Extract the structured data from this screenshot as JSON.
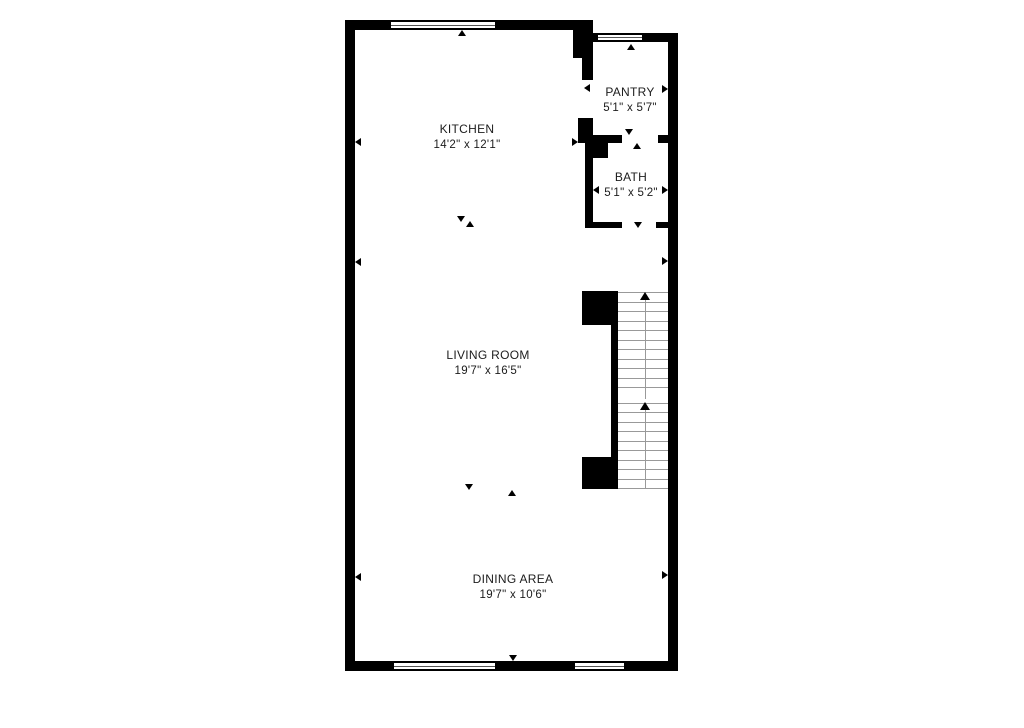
{
  "canvas": {
    "background": "#ffffff"
  },
  "floorplan": {
    "wall_color": "#000000",
    "stair_tread_color": "#999999",
    "rooms": [
      {
        "id": "kitchen",
        "name": "KITCHEN",
        "dimensions": "14'2\" x 12'1\""
      },
      {
        "id": "pantry",
        "name": "PANTRY",
        "dimensions": "5'1\" x 5'7\""
      },
      {
        "id": "bath",
        "name": "BATH",
        "dimensions": "5'1\" x 5'2\""
      },
      {
        "id": "living_room",
        "name": "LIVING ROOM",
        "dimensions": "19'7\" x 16'5\""
      },
      {
        "id": "dining_area",
        "name": "DINING AREA",
        "dimensions": "19'7\" x 10'6\""
      }
    ],
    "stairs": {
      "direction": "up",
      "flights": [
        {
          "treads": 11
        },
        {
          "treads": 10
        }
      ]
    }
  }
}
